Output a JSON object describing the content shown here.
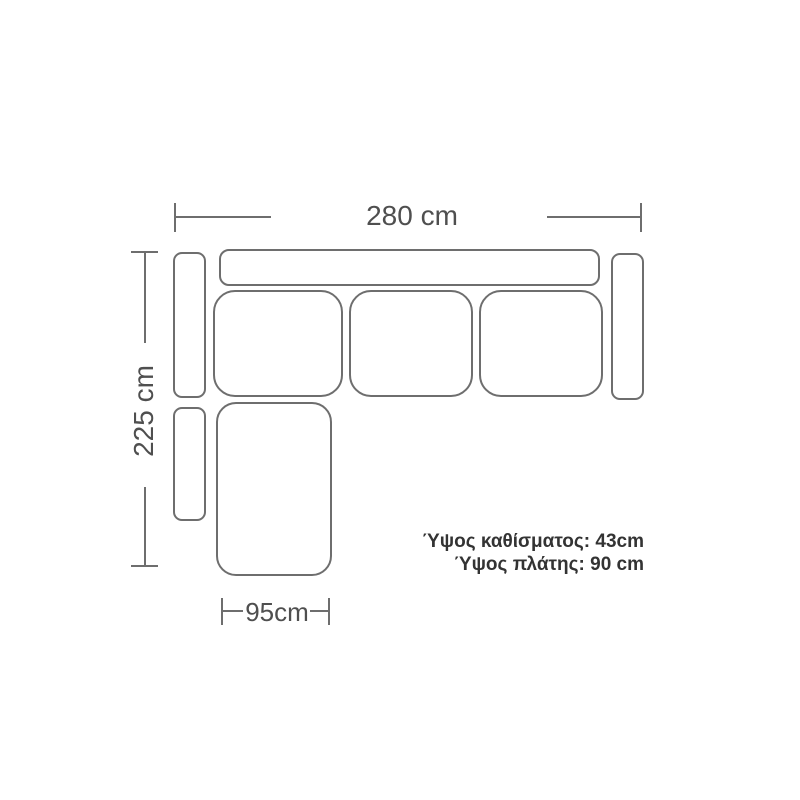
{
  "diagram": {
    "background_color": "#ffffff",
    "stroke_color": "#6e6e6e",
    "dimension_text_color": "#4f4f4f",
    "note_text_color": "#333333",
    "dimensions": {
      "overall_width": "280 cm",
      "overall_depth": "225 cm",
      "chaise_width": "95cm"
    },
    "notes": {
      "seat_height": "Ύψος καθίσματος: 43cm",
      "back_height": "Ύψος πλάτης: 90 cm"
    }
  }
}
